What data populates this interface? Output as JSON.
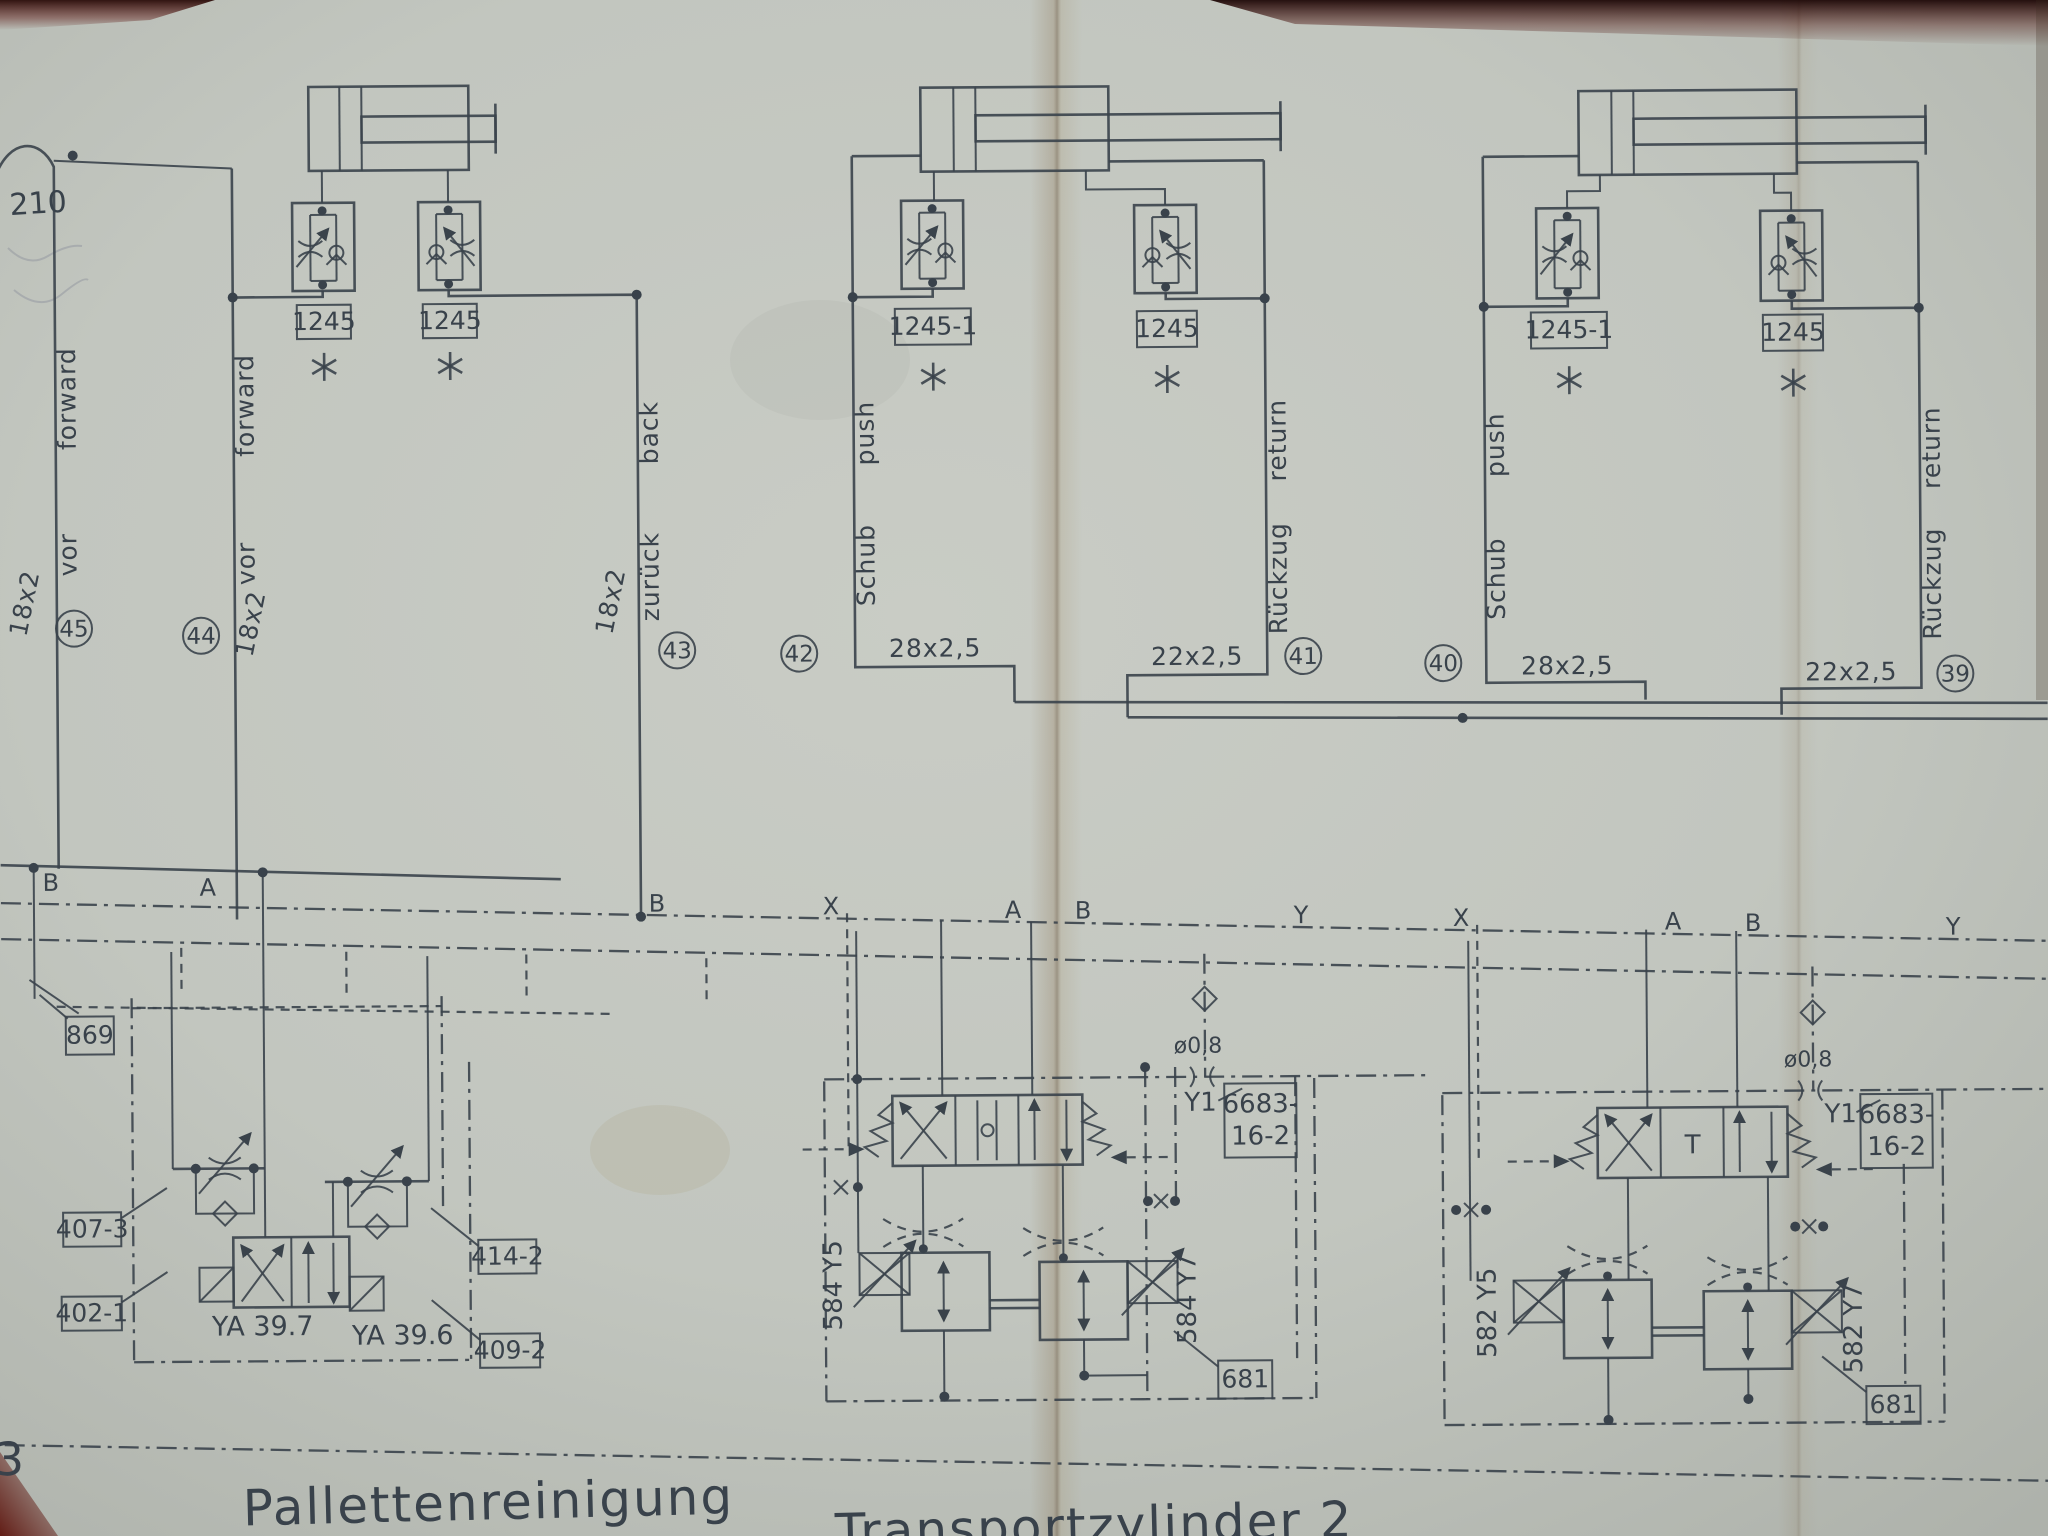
{
  "artifact": {
    "sheet_corner_number": "3",
    "pipe_note": "210",
    "footnote_marker_icon": "asterisk (6-ray) drawn as shape",
    "ink_color": "#3a434b",
    "paper_color": "#c3c7c0"
  },
  "titles": {
    "station1": "Pallettenreinigung",
    "station2": "Transportzylinder 2"
  },
  "flow_controls": {
    "labels": [
      "1245",
      "1245",
      "1245-1",
      "1245",
      "1245-1",
      "1245"
    ]
  },
  "pipes": [
    {
      "no": "45",
      "size": "18x2",
      "de": "vor",
      "en": "forward"
    },
    {
      "no": "44",
      "size": "18x2",
      "de": "vor",
      "en": "forward"
    },
    {
      "no": "43",
      "size": "18x2",
      "de": "zurück",
      "en": "back"
    },
    {
      "no": "42",
      "size": "28x2,5",
      "de": "Schub",
      "en": "push"
    },
    {
      "no": "41",
      "size": "22x2,5",
      "de": "Rückzug",
      "en": "return"
    },
    {
      "no": "40",
      "size": "28x2,5",
      "de": "Schub",
      "en": "push"
    },
    {
      "no": "39",
      "size": "22x2,5",
      "de": "Rückzug",
      "en": "return"
    }
  ],
  "ports": {
    "letters": [
      "B",
      "A",
      "B",
      "X",
      "A",
      "B",
      "Y",
      "X",
      "A",
      "B",
      "Y"
    ]
  },
  "station1": {
    "refs": {
      "r869": "869",
      "r407": "407-3",
      "r402": "402-1",
      "r414": "414-2",
      "r409": "409-2"
    },
    "solenoid_left": "YA 39.7",
    "solenoid_right": "YA 39.6"
  },
  "station2": {
    "solenoid_left": "584 Y5",
    "solenoid_right": "584 Y7",
    "pilot": "Y1",
    "valve_ref_line1": "6683-",
    "valve_ref_line2": "16-2",
    "block_ref": "681",
    "orifice": "ø0,8"
  },
  "station3": {
    "solenoid_left": "582 Y5",
    "solenoid_right": "582 Y7",
    "pilot": "Y1",
    "valve_ref_line1": "6683-",
    "valve_ref_line2": "16-2",
    "block_ref": "681",
    "orifice": "ø0,8",
    "tank_mark": "T"
  }
}
